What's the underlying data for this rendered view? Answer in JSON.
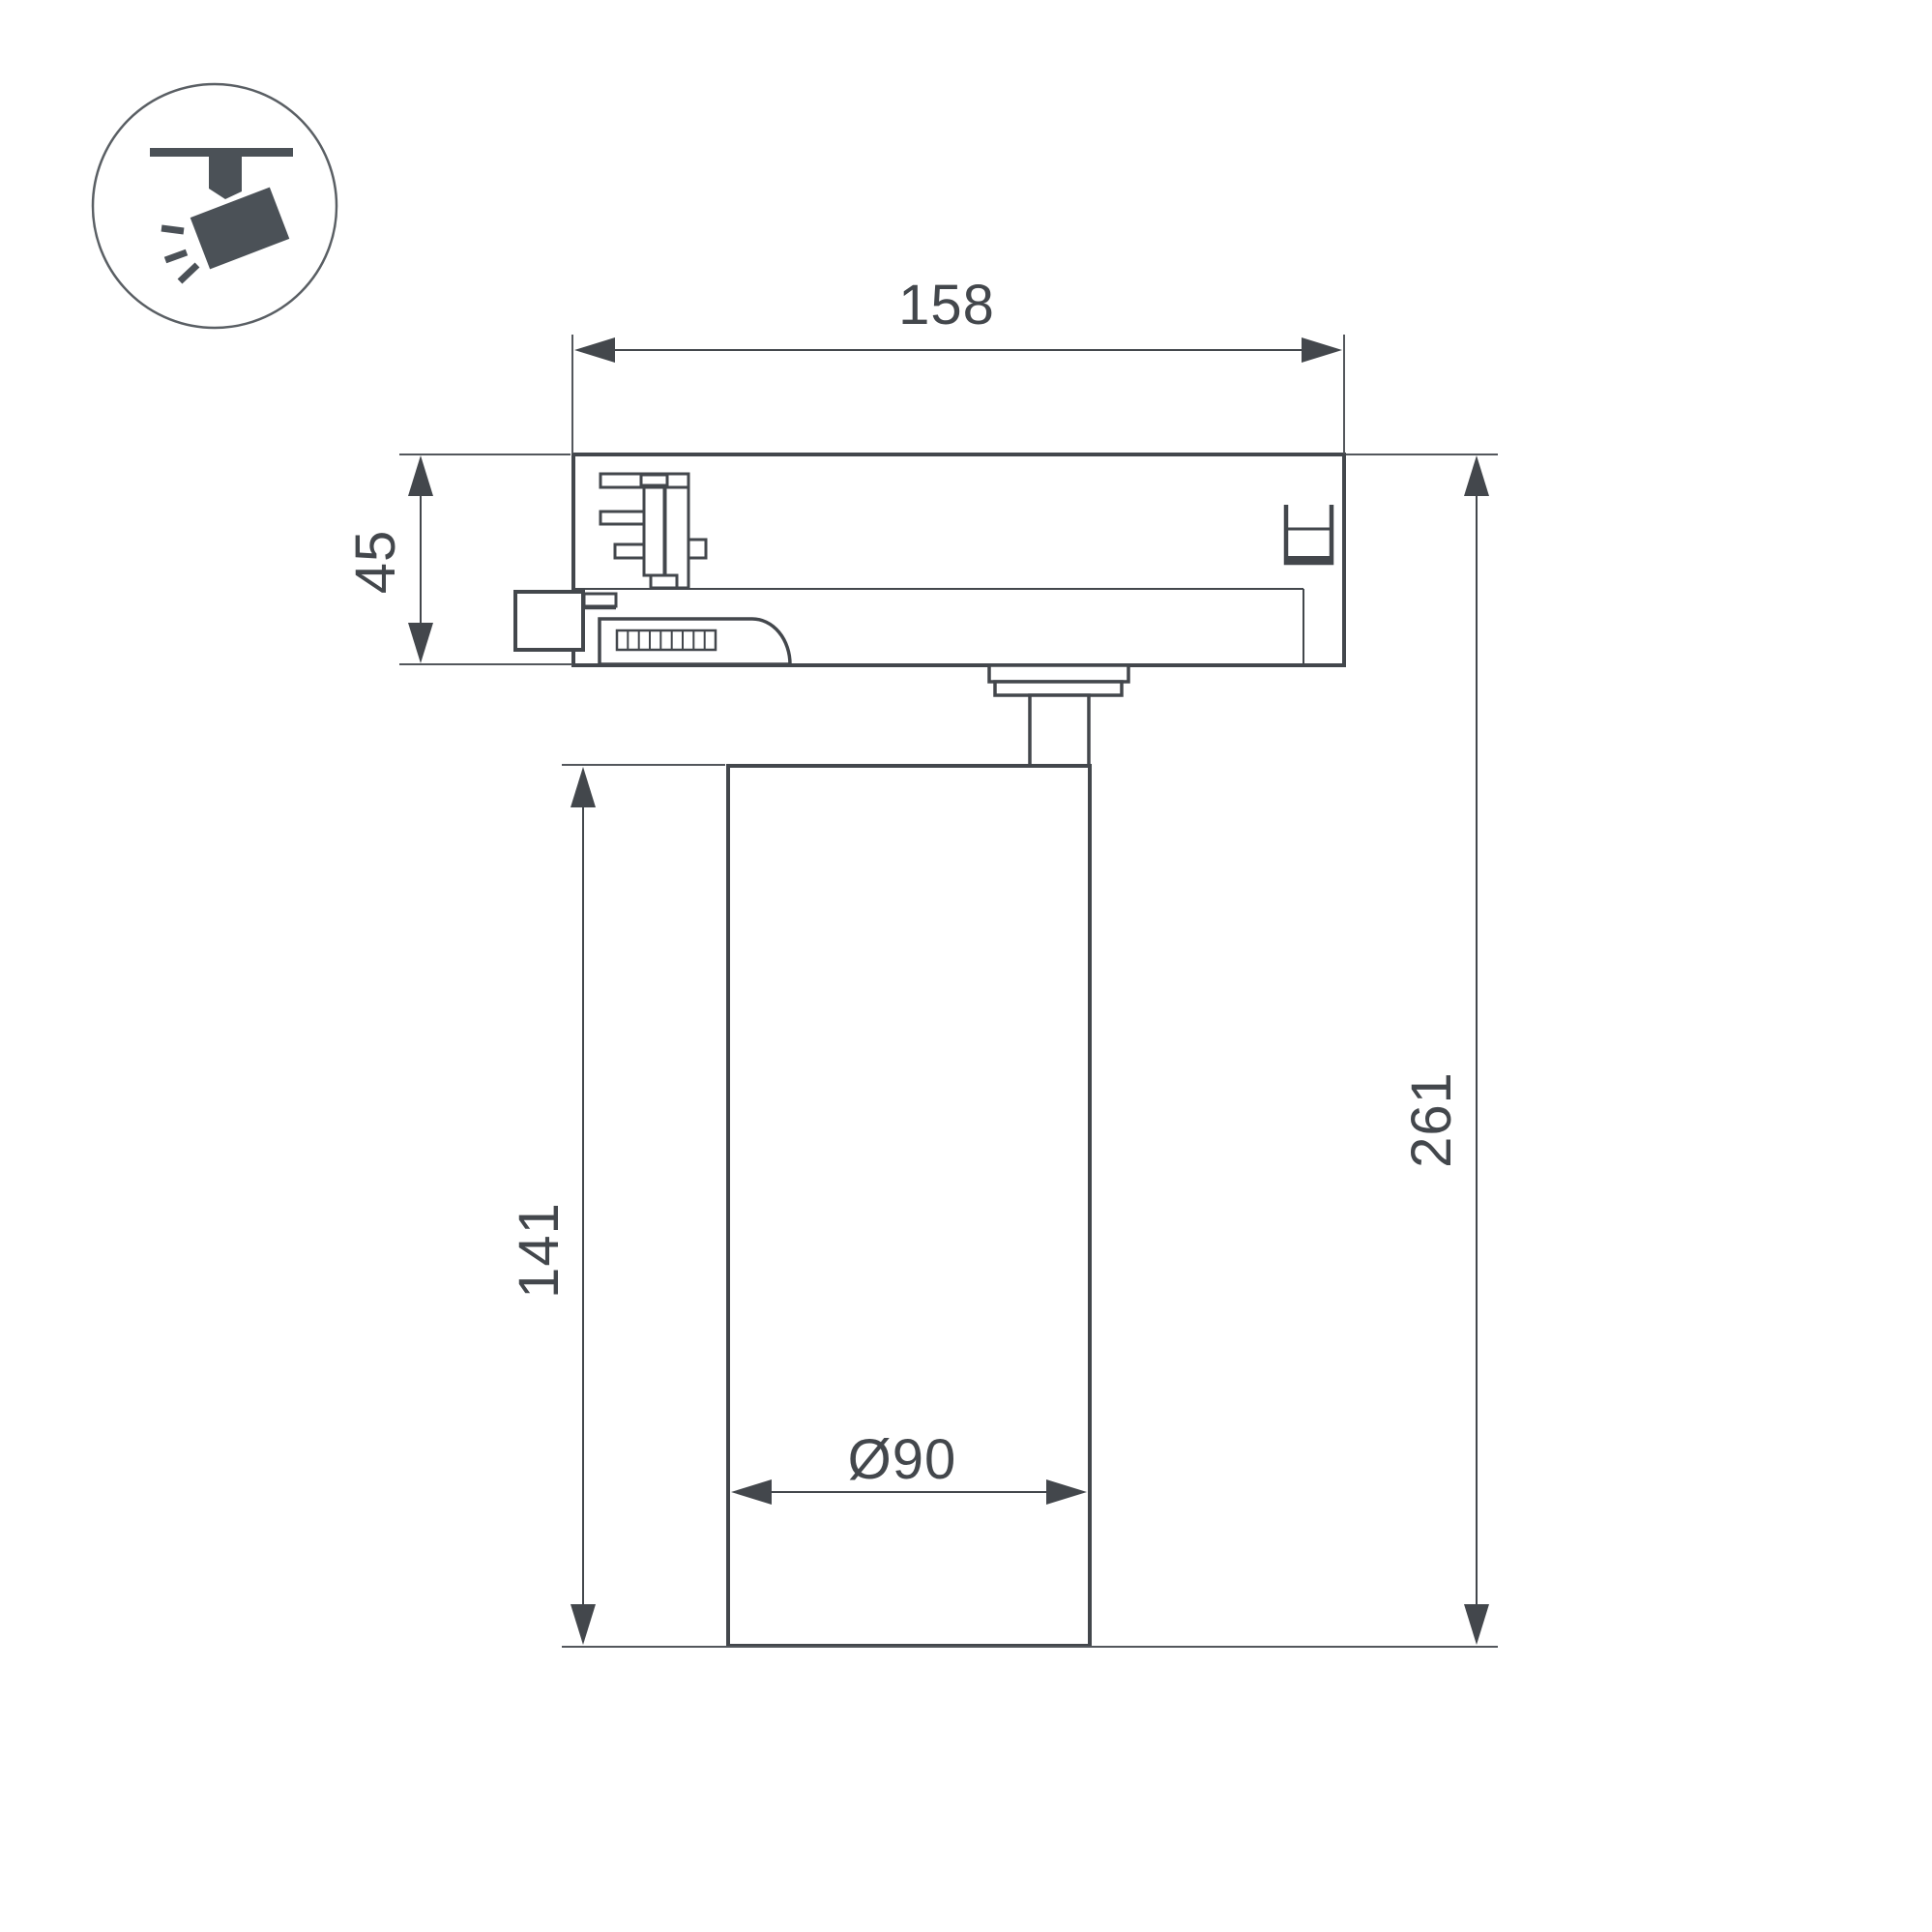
{
  "canvas": {
    "background": "#ffffff",
    "line_color": "#43474c",
    "dim_line_color": "#53575c"
  },
  "icon": {
    "name": "track-spotlight-icon",
    "fill": "#4b5157"
  },
  "dimensions": {
    "adapter_width": "158",
    "adapter_height": "45",
    "body_height": "141",
    "total_height": "261",
    "body_diameter": "Ø90"
  }
}
